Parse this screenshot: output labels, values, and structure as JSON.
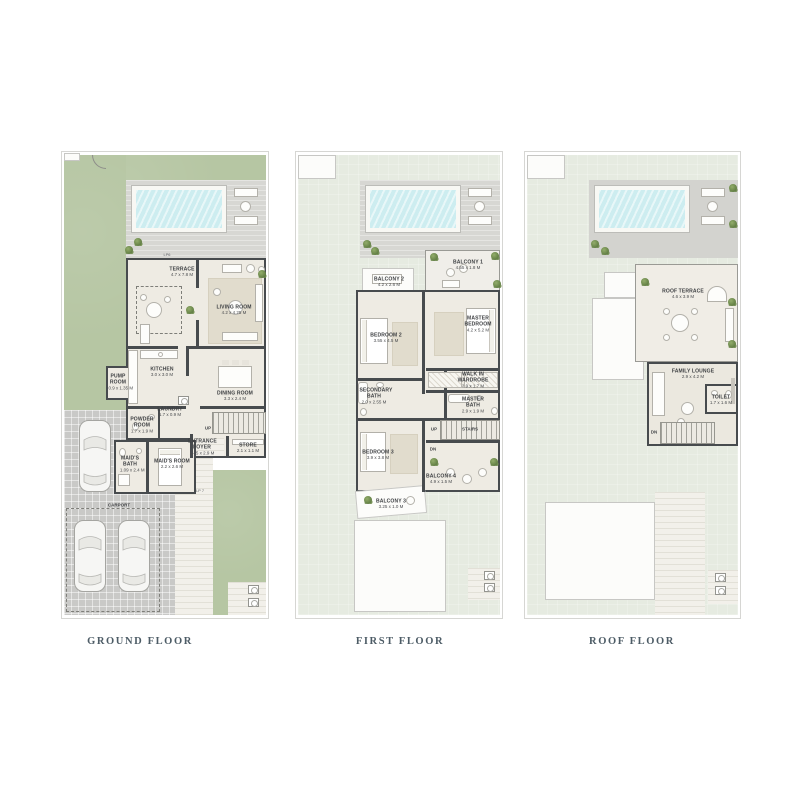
{
  "document": {
    "background": "#ffffff"
  },
  "colors": {
    "grass": "#b6c6a3",
    "pale_lawn": "#e6ebe1",
    "pool_water": "#cdedf0",
    "deck": "#d7d7d3",
    "interior": "#eeebe3",
    "wall": "#474b4e",
    "title_text": "#4d5c66"
  },
  "floors": {
    "ground": {
      "title": "GROUND FLOOR",
      "rooms": {
        "terrace": {
          "name": "TERRACE",
          "dims": "4.7 x 7.8 M"
        },
        "living": {
          "name": "LIVING ROOM",
          "dims": "4.2 x 4.25 M"
        },
        "kitchen": {
          "name": "KITCHEN",
          "dims": "3.0 x 3.0 M"
        },
        "dining": {
          "name": "DINING ROOM",
          "dims": "3.3 x 2.4 M"
        },
        "laundry": {
          "name": "LAUNDRY",
          "dims": "1.7 x 0.9 M"
        },
        "powder": {
          "name": "POWDER ROOM",
          "dims": "1.7 x 1.9 M"
        },
        "pump": {
          "name": "PUMP ROOM",
          "dims": "0.9 x 1.35 M"
        },
        "maids_bath": {
          "name": "MAID'S BATH",
          "dims": "1.09 x 2.4 M"
        },
        "maids_room": {
          "name": "MAID'S ROOM",
          "dims": "2.2 x 2.6 M"
        },
        "foyer": {
          "name": "ENTRANCE FOYER",
          "dims": "1.45 x 2.9 M"
        },
        "store": {
          "name": "STORE",
          "dims": "2.1 x 1.1 M"
        }
      },
      "annotations": {
        "carport": "CARPORT",
        "up": "UP",
        "lp6": "LP6",
        "lp7": "LP 7"
      }
    },
    "first": {
      "title": "FIRST FLOOR",
      "rooms": {
        "balcony1": {
          "name": "BALCONY 1",
          "dims": "4.55 x 1.8 M"
        },
        "balcony2": {
          "name": "BALCONY 2",
          "dims": "4.2 x 2.6 M"
        },
        "bedroom2": {
          "name": "BEDROOM 2",
          "dims": "3.55 x 4.5 M"
        },
        "master": {
          "name": "MASTER BEDROOM",
          "dims": "4.2 x 5.2 M"
        },
        "wardrobe": {
          "name": "WALK IN WARDROBE",
          "dims": "2.9 x 1.7 M"
        },
        "secondary_bath": {
          "name": "SECONDARY BATH",
          "dims": "2.0 x 2.55 M"
        },
        "master_bath": {
          "name": "MASTER BATH",
          "dims": "2.9 x 1.9 M"
        },
        "bedroom3": {
          "name": "BEDROOM 3",
          "dims": "3.9 x 3.8 M"
        },
        "balcony4": {
          "name": "BALCONY 4",
          "dims": "4.9 x 1.5 M"
        },
        "balcony3": {
          "name": "BALCONY 3",
          "dims": "3.25 x 1.0 M"
        }
      },
      "annotations": {
        "up": "UP",
        "dn": "DN",
        "stairs": "STAIRS"
      }
    },
    "roof": {
      "title": "ROOF FLOOR",
      "rooms": {
        "roof_terrace": {
          "name": "ROOF TERRACE",
          "dims": "4.6 x 3.9 M"
        },
        "family_lounge": {
          "name": "FAMILY LOUNGE",
          "dims": "2.9 x 4.2 M"
        },
        "toilet": {
          "name": "TOILET",
          "dims": "1.7 x 1.6 M"
        }
      },
      "annotations": {
        "dn": "DN"
      }
    }
  }
}
